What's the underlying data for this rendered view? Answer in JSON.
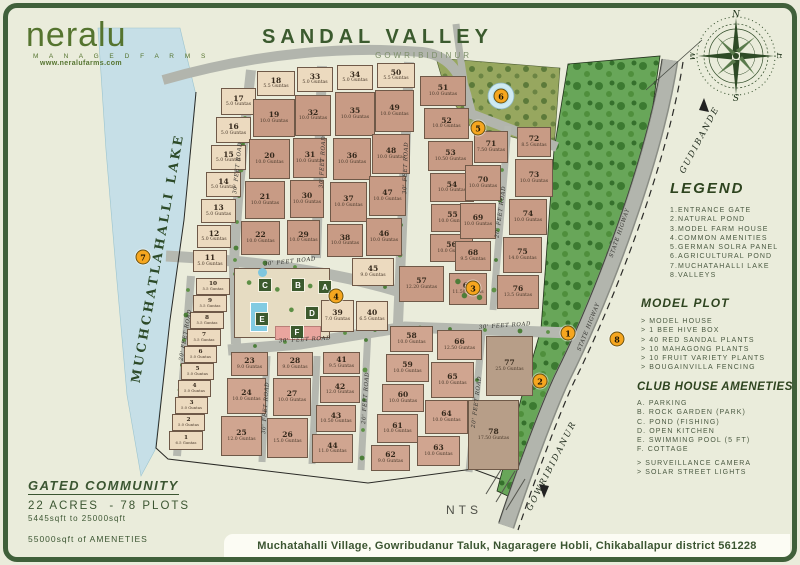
{
  "logo": {
    "name": "neralu",
    "tagline": "M A N A G E D   F A R M S",
    "website": "www.neralufarms.com"
  },
  "title": {
    "main": "SANDAL VALLEY",
    "sub": "GOWRIBIDINUR"
  },
  "compass": {
    "n": "N",
    "e": "E",
    "s": "S",
    "w": "W"
  },
  "panels": {
    "legend": {
      "heading": "LEGEND",
      "items": [
        "1.ENTRANCE GATE",
        "2.NATURAL POND",
        "3.MODEL FARM HOUSE",
        "4.COMMON AMENITIES",
        "5.GERMAN SOLRA PANEL",
        "6.AGRICULTURAL POND",
        "7.MUCHATAHALLI LAKE",
        "8.VALLEYS"
      ]
    },
    "model_plot": {
      "heading": "MODEL PLOT",
      "items": [
        "> MODEL HOUSE",
        "> 1 BEE HIVE BOX",
        "> 40 RED SANDAL PLANTS",
        "> 10 MAHAGONG PLANTS",
        "> 10 FRUIT VARIETY PLANTS",
        "> BOUGAINVILLA FENCING"
      ]
    },
    "club_house": {
      "heading": "CLUB HOUSE AMENETIES",
      "items": [
        "A. PARKING",
        "B. ROCK GARDEN (PARK)",
        "C. POND (FISHING)",
        "D. OPEN KITCHEN",
        "E. SWIMMING POOL (5 FT)",
        "F. COTTAGE"
      ],
      "extras": [
        "> SURVEILLANCE CAMERA",
        "> SOLAR STREET LIGHTS"
      ]
    },
    "summary": {
      "heading": "GATED COMMUNITY",
      "line1": "22 ACRES  - 78 PLOTS",
      "line2": "5445sqft to 25000sqft",
      "line3": "55000sqft of AMENETIES"
    },
    "address": "Muchatahalli Village, Gowribudanur Taluk, Nagaragere Hobli, Chikaballapur district 561228"
  },
  "map": {
    "lake_label": "MUCHCHATLAHALLI LAKE",
    "nts": "NTS",
    "highway": {
      "top": "GUDIBANDE",
      "bottom": "GOWRIBIDANUR"
    },
    "units_suffix": "Guntas",
    "road_labels": [
      {
        "t": "30' FEET ROAD",
        "x": 238,
        "y": 168,
        "r": -84
      },
      {
        "t": "30' FEET ROAD",
        "x": 323,
        "y": 162,
        "r": -87
      },
      {
        "t": "30' FEET ROAD",
        "x": 406,
        "y": 168,
        "r": -88
      },
      {
        "t": "20' FEET ROAD",
        "x": 501,
        "y": 212,
        "r": -82
      },
      {
        "t": "20' FEET ROAD",
        "x": 186,
        "y": 335,
        "r": -80
      },
      {
        "t": "30' FEET ROAD",
        "x": 290,
        "y": 262,
        "r": -6
      },
      {
        "t": "30' FEET ROAD",
        "x": 305,
        "y": 340,
        "r": -3
      },
      {
        "t": "30' FEET ROAD",
        "x": 505,
        "y": 326,
        "r": -4
      },
      {
        "t": "30' FEET ROAD",
        "x": 266,
        "y": 408,
        "r": -86
      },
      {
        "t": "20' FEET ROAD",
        "x": 366,
        "y": 398,
        "r": -86
      },
      {
        "t": "20' FEET ROAD",
        "x": 477,
        "y": 402,
        "r": -83
      },
      {
        "t": "STATE HIGWAY",
        "x": 620,
        "y": 233,
        "r": -71
      },
      {
        "t": "STATE HIGWAY",
        "x": 589,
        "y": 327,
        "r": -68
      }
    ],
    "markers": [
      {
        "n": "1",
        "x": 568,
        "y": 333
      },
      {
        "n": "2",
        "x": 540,
        "y": 381
      },
      {
        "n": "3",
        "x": 473,
        "y": 288
      },
      {
        "n": "4",
        "x": 336,
        "y": 296
      },
      {
        "n": "5",
        "x": 478,
        "y": 128
      },
      {
        "n": "6",
        "x": 501,
        "y": 96
      },
      {
        "n": "7",
        "x": 143,
        "y": 257
      },
      {
        "n": "8",
        "x": 617,
        "y": 339
      }
    ],
    "club_letters": [
      {
        "t": "C",
        "x": 265,
        "y": 285
      },
      {
        "t": "B",
        "x": 298,
        "y": 285
      },
      {
        "t": "A",
        "x": 325,
        "y": 287
      },
      {
        "t": "D",
        "x": 312,
        "y": 313
      },
      {
        "t": "E",
        "x": 262,
        "y": 319
      },
      {
        "t": "F",
        "x": 297,
        "y": 332
      }
    ],
    "plots": [
      {
        "n": 17,
        "g": "5.0",
        "x": 221,
        "y": 88,
        "w": 35,
        "h": 27,
        "c": "l"
      },
      {
        "n": 16,
        "g": "5.0",
        "x": 216,
        "y": 117,
        "w": 35,
        "h": 26,
        "c": "l"
      },
      {
        "n": 15,
        "g": "5.0",
        "x": 211,
        "y": 145,
        "w": 35,
        "h": 25,
        "c": "l"
      },
      {
        "n": 14,
        "g": "5.0",
        "x": 206,
        "y": 172,
        "w": 35,
        "h": 25,
        "c": "l"
      },
      {
        "n": 13,
        "g": "5.0",
        "x": 201,
        "y": 199,
        "w": 35,
        "h": 24,
        "c": "l"
      },
      {
        "n": 12,
        "g": "5.0",
        "x": 197,
        "y": 225,
        "w": 34,
        "h": 23,
        "c": "l"
      },
      {
        "n": 11,
        "g": "5.0",
        "x": 193,
        "y": 250,
        "w": 34,
        "h": 22,
        "c": "l"
      },
      {
        "n": 10,
        "g": "5.5",
        "x": 196,
        "y": 278,
        "w": 34,
        "h": 17,
        "c": "l"
      },
      {
        "n": 9,
        "g": "5.5",
        "x": 193,
        "y": 295,
        "w": 34,
        "h": 17,
        "c": "l"
      },
      {
        "n": 8,
        "g": "5.5",
        "x": 190,
        "y": 312,
        "w": 34,
        "h": 17,
        "c": "l"
      },
      {
        "n": 7,
        "g": "5.5",
        "x": 187,
        "y": 329,
        "w": 34,
        "h": 17,
        "c": "l"
      },
      {
        "n": 6,
        "g": "5.0",
        "x": 184,
        "y": 346,
        "w": 33,
        "h": 17,
        "c": "l"
      },
      {
        "n": 5,
        "g": "5.0",
        "x": 181,
        "y": 363,
        "w": 33,
        "h": 17,
        "c": "l"
      },
      {
        "n": 4,
        "g": "5.0",
        "x": 178,
        "y": 380,
        "w": 33,
        "h": 17,
        "c": "l"
      },
      {
        "n": 3,
        "g": "5.0",
        "x": 175,
        "y": 397,
        "w": 33,
        "h": 17,
        "c": "l"
      },
      {
        "n": 2,
        "g": "5.0",
        "x": 172,
        "y": 414,
        "w": 33,
        "h": 17,
        "c": "l"
      },
      {
        "n": 1,
        "g": "6.5",
        "x": 169,
        "y": 431,
        "w": 34,
        "h": 19,
        "c": "l"
      },
      {
        "n": 18,
        "g": "5.5",
        "x": 257,
        "y": 71,
        "w": 38,
        "h": 25,
        "c": "l"
      },
      {
        "n": 19,
        "g": "10.0",
        "x": 253,
        "y": 99,
        "w": 42,
        "h": 38,
        "c": "b"
      },
      {
        "n": 20,
        "g": "10.0",
        "x": 249,
        "y": 139,
        "w": 41,
        "h": 40,
        "c": "b"
      },
      {
        "n": 21,
        "g": "10.0",
        "x": 245,
        "y": 181,
        "w": 40,
        "h": 38,
        "c": "b"
      },
      {
        "n": 22,
        "g": "10.0",
        "x": 241,
        "y": 221,
        "w": 39,
        "h": 34,
        "c": "b"
      },
      {
        "n": 33,
        "g": "5.0",
        "x": 297,
        "y": 67,
        "w": 36,
        "h": 25,
        "c": "l"
      },
      {
        "n": 32,
        "g": "10.0",
        "x": 295,
        "y": 95,
        "w": 36,
        "h": 41,
        "c": "b"
      },
      {
        "n": 31,
        "g": "10.0",
        "x": 293,
        "y": 138,
        "w": 34,
        "h": 40,
        "c": "b"
      },
      {
        "n": 30,
        "g": "10.0",
        "x": 290,
        "y": 180,
        "w": 34,
        "h": 38,
        "c": "b"
      },
      {
        "n": 29,
        "g": "10.0",
        "x": 287,
        "y": 220,
        "w": 33,
        "h": 35,
        "c": "b"
      },
      {
        "n": 34,
        "g": "5.0",
        "x": 337,
        "y": 65,
        "w": 36,
        "h": 25,
        "c": "l"
      },
      {
        "n": 35,
        "g": "10.0",
        "x": 335,
        "y": 92,
        "w": 40,
        "h": 44,
        "c": "b"
      },
      {
        "n": 36,
        "g": "10.0",
        "x": 333,
        "y": 138,
        "w": 38,
        "h": 42,
        "c": "b"
      },
      {
        "n": 37,
        "g": "10.0",
        "x": 330,
        "y": 182,
        "w": 37,
        "h": 40,
        "c": "b"
      },
      {
        "n": 38,
        "g": "10.0",
        "x": 327,
        "y": 224,
        "w": 36,
        "h": 33,
        "c": "b"
      },
      {
        "n": 50,
        "g": "5.5",
        "x": 377,
        "y": 63,
        "w": 38,
        "h": 25,
        "c": "l"
      },
      {
        "n": 49,
        "g": "10.0",
        "x": 375,
        "y": 90,
        "w": 39,
        "h": 42,
        "c": "b"
      },
      {
        "n": 48,
        "g": "10.0",
        "x": 372,
        "y": 134,
        "w": 38,
        "h": 40,
        "c": "b"
      },
      {
        "n": 47,
        "g": "10.0",
        "x": 369,
        "y": 176,
        "w": 37,
        "h": 40,
        "c": "b"
      },
      {
        "n": 46,
        "g": "10.0",
        "x": 366,
        "y": 218,
        "w": 36,
        "h": 38,
        "c": "b"
      },
      {
        "n": 45,
        "g": "9.0",
        "x": 352,
        "y": 258,
        "w": 42,
        "h": 28,
        "c": "l"
      },
      {
        "n": 51,
        "g": "10.0",
        "x": 420,
        "y": 76,
        "w": 46,
        "h": 30,
        "c": "b"
      },
      {
        "n": 52,
        "g": "10.0",
        "x": 424,
        "y": 108,
        "w": 45,
        "h": 31,
        "c": "b"
      },
      {
        "n": 53,
        "g": "10.50",
        "x": 428,
        "y": 141,
        "w": 45,
        "h": 30,
        "c": "b"
      },
      {
        "n": 54,
        "g": "10.0",
        "x": 430,
        "y": 173,
        "w": 44,
        "h": 29,
        "c": "b"
      },
      {
        "n": 55,
        "g": "10.0",
        "x": 431,
        "y": 204,
        "w": 43,
        "h": 28,
        "c": "b"
      },
      {
        "n": 56,
        "g": "10.0",
        "x": 430,
        "y": 234,
        "w": 43,
        "h": 28,
        "c": "b"
      },
      {
        "n": 57,
        "g": "12.20",
        "x": 399,
        "y": 266,
        "w": 45,
        "h": 36,
        "c": "b"
      },
      {
        "n": 71,
        "g": "7.50",
        "x": 474,
        "y": 131,
        "w": 34,
        "h": 32,
        "c": "b"
      },
      {
        "n": 70,
        "g": "10.0",
        "x": 465,
        "y": 165,
        "w": 36,
        "h": 36,
        "c": "b"
      },
      {
        "n": 69,
        "g": "10.0",
        "x": 460,
        "y": 203,
        "w": 36,
        "h": 36,
        "c": "b"
      },
      {
        "n": 68,
        "g": "9.5",
        "x": 455,
        "y": 241,
        "w": 36,
        "h": 30,
        "c": "b"
      },
      {
        "n": 67,
        "g": "11.50",
        "x": 449,
        "y": 273,
        "w": 38,
        "h": 32,
        "c": "b",
        "t": 1
      },
      {
        "n": 72,
        "g": "8.5",
        "x": 517,
        "y": 127,
        "w": 34,
        "h": 30,
        "c": "b"
      },
      {
        "n": 73,
        "g": "10.0",
        "x": 515,
        "y": 159,
        "w": 38,
        "h": 38,
        "c": "b"
      },
      {
        "n": 74,
        "g": "10.0",
        "x": 509,
        "y": 199,
        "w": 38,
        "h": 36,
        "c": "b"
      },
      {
        "n": 75,
        "g": "14.0",
        "x": 503,
        "y": 237,
        "w": 39,
        "h": 36,
        "c": "b"
      },
      {
        "n": 76,
        "g": "13.5",
        "x": 497,
        "y": 275,
        "w": 42,
        "h": 34,
        "c": "b"
      },
      {
        "n": 39,
        "g": "7.0",
        "x": 321,
        "y": 300,
        "w": 33,
        "h": 32,
        "c": "l"
      },
      {
        "n": 40,
        "g": "6.5",
        "x": 356,
        "y": 301,
        "w": 32,
        "h": 30,
        "c": "l"
      },
      {
        "n": 23,
        "g": "9.0",
        "x": 231,
        "y": 352,
        "w": 37,
        "h": 24,
        "c": "m"
      },
      {
        "n": 24,
        "g": "10.0",
        "x": 227,
        "y": 378,
        "w": 39,
        "h": 36,
        "c": "m"
      },
      {
        "n": 25,
        "g": "12.0",
        "x": 221,
        "y": 416,
        "w": 41,
        "h": 40,
        "c": "m"
      },
      {
        "n": 28,
        "g": "9.0",
        "x": 277,
        "y": 352,
        "w": 36,
        "h": 24,
        "c": "m"
      },
      {
        "n": 27,
        "g": "10.0",
        "x": 273,
        "y": 378,
        "w": 38,
        "h": 38,
        "c": "m"
      },
      {
        "n": 26,
        "g": "15.0",
        "x": 267,
        "y": 418,
        "w": 41,
        "h": 40,
        "c": "m"
      },
      {
        "n": 41,
        "g": "9.5",
        "x": 323,
        "y": 352,
        "w": 37,
        "h": 22,
        "c": "m"
      },
      {
        "n": 42,
        "g": "12.0",
        "x": 320,
        "y": 376,
        "w": 40,
        "h": 27,
        "c": "m"
      },
      {
        "n": 43,
        "g": "10.50",
        "x": 316,
        "y": 405,
        "w": 40,
        "h": 27,
        "c": "m"
      },
      {
        "n": 44,
        "g": "11.0",
        "x": 312,
        "y": 434,
        "w": 41,
        "h": 29,
        "c": "m"
      },
      {
        "n": 58,
        "g": "10.0",
        "x": 390,
        "y": 326,
        "w": 43,
        "h": 26,
        "c": "m"
      },
      {
        "n": 59,
        "g": "10.0",
        "x": 386,
        "y": 354,
        "w": 43,
        "h": 28,
        "c": "m"
      },
      {
        "n": 60,
        "g": "10.0",
        "x": 382,
        "y": 384,
        "w": 42,
        "h": 28,
        "c": "m"
      },
      {
        "n": 61,
        "g": "10.0",
        "x": 377,
        "y": 414,
        "w": 41,
        "h": 29,
        "c": "m"
      },
      {
        "n": 62,
        "g": "9.0",
        "x": 371,
        "y": 445,
        "w": 39,
        "h": 26,
        "c": "m"
      },
      {
        "n": 66,
        "g": "12.50",
        "x": 437,
        "y": 330,
        "w": 45,
        "h": 30,
        "c": "m"
      },
      {
        "n": 65,
        "g": "10.0",
        "x": 431,
        "y": 362,
        "w": 43,
        "h": 36,
        "c": "m"
      },
      {
        "n": 64,
        "g": "10.0",
        "x": 425,
        "y": 400,
        "w": 43,
        "h": 34,
        "c": "m"
      },
      {
        "n": 63,
        "g": "10.0",
        "x": 417,
        "y": 436,
        "w": 43,
        "h": 30,
        "c": "m"
      },
      {
        "n": 77,
        "g": "25.0",
        "x": 486,
        "y": 336,
        "w": 47,
        "h": 60,
        "c": "g"
      },
      {
        "n": 78,
        "g": "17.50",
        "x": 468,
        "y": 400,
        "w": 51,
        "h": 70,
        "c": "g"
      }
    ]
  }
}
